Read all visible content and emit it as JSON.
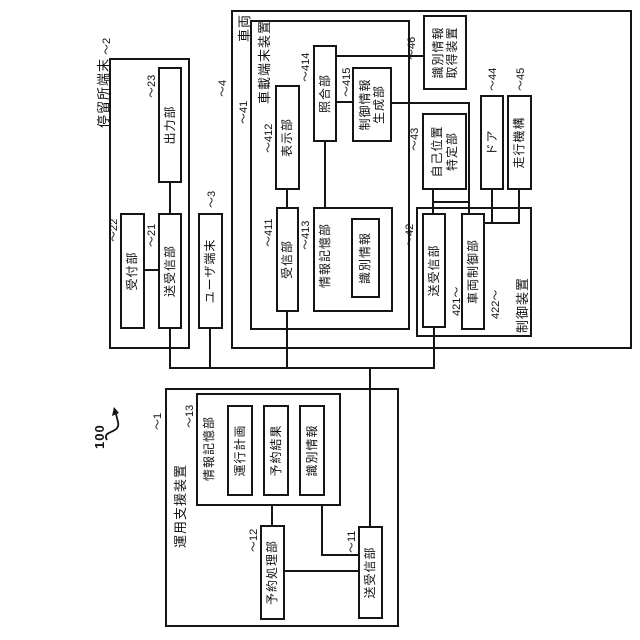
{
  "figure": {
    "system_ref": "100"
  },
  "boxes": {
    "support_device": {
      "label": "運用支援装置",
      "ref": "〜1"
    },
    "info_storage_13": {
      "label": "情報記憶部",
      "ref": "〜13"
    },
    "operation_plan": {
      "label": "運行計画"
    },
    "reservation_result": {
      "label": "予約結果"
    },
    "id_info_13": {
      "label": "識別情報"
    },
    "reservation_processing": {
      "label": "予約処理部",
      "ref": "〜12"
    },
    "transceiver_11": {
      "label": "送受信部",
      "ref": "〜11"
    },
    "stop_terminal": {
      "label": "停留所端末",
      "ref": "〜2"
    },
    "output_23": {
      "label": "出力部",
      "ref": "〜23"
    },
    "reception_22": {
      "label": "受付部",
      "ref": "〜22"
    },
    "transceiver_21": {
      "label": "送受信部",
      "ref": "〜21"
    },
    "user_terminal": {
      "label": "ユーザ端末",
      "ref": "〜3"
    },
    "vehicle": {
      "label": "車両",
      "ref": "〜4"
    },
    "onboard_terminal": {
      "label": "車載端末装置",
      "ref": "〜41"
    },
    "receiver_411": {
      "label": "受信部",
      "ref": "〜411"
    },
    "display_412": {
      "label": "表示部",
      "ref": "〜412"
    },
    "info_storage_413": {
      "label": "情報記憶部",
      "ref": "〜413"
    },
    "id_info_413": {
      "label": "識別情報"
    },
    "matching_414": {
      "label": "照合部",
      "ref": "〜414"
    },
    "control_info_gen_415": {
      "label": "制御情報\n生成部",
      "ref": "〜415"
    },
    "control_device_42": {
      "label": "制御装置",
      "ref": "〜42"
    },
    "transceiver_421": {
      "label": "送受信部",
      "ref": "421〜"
    },
    "vehicle_control_422": {
      "label": "車両制御部",
      "ref": "422〜"
    },
    "self_position_43": {
      "label": "自己位置\n特定部",
      "ref": "〜43"
    },
    "door_44": {
      "label": "ドア",
      "ref": "〜44"
    },
    "drive_45": {
      "label": "走行機構",
      "ref": "〜45"
    },
    "id_acquisition_46": {
      "label": "識別情報\n取得装置",
      "ref": "〜46"
    }
  }
}
